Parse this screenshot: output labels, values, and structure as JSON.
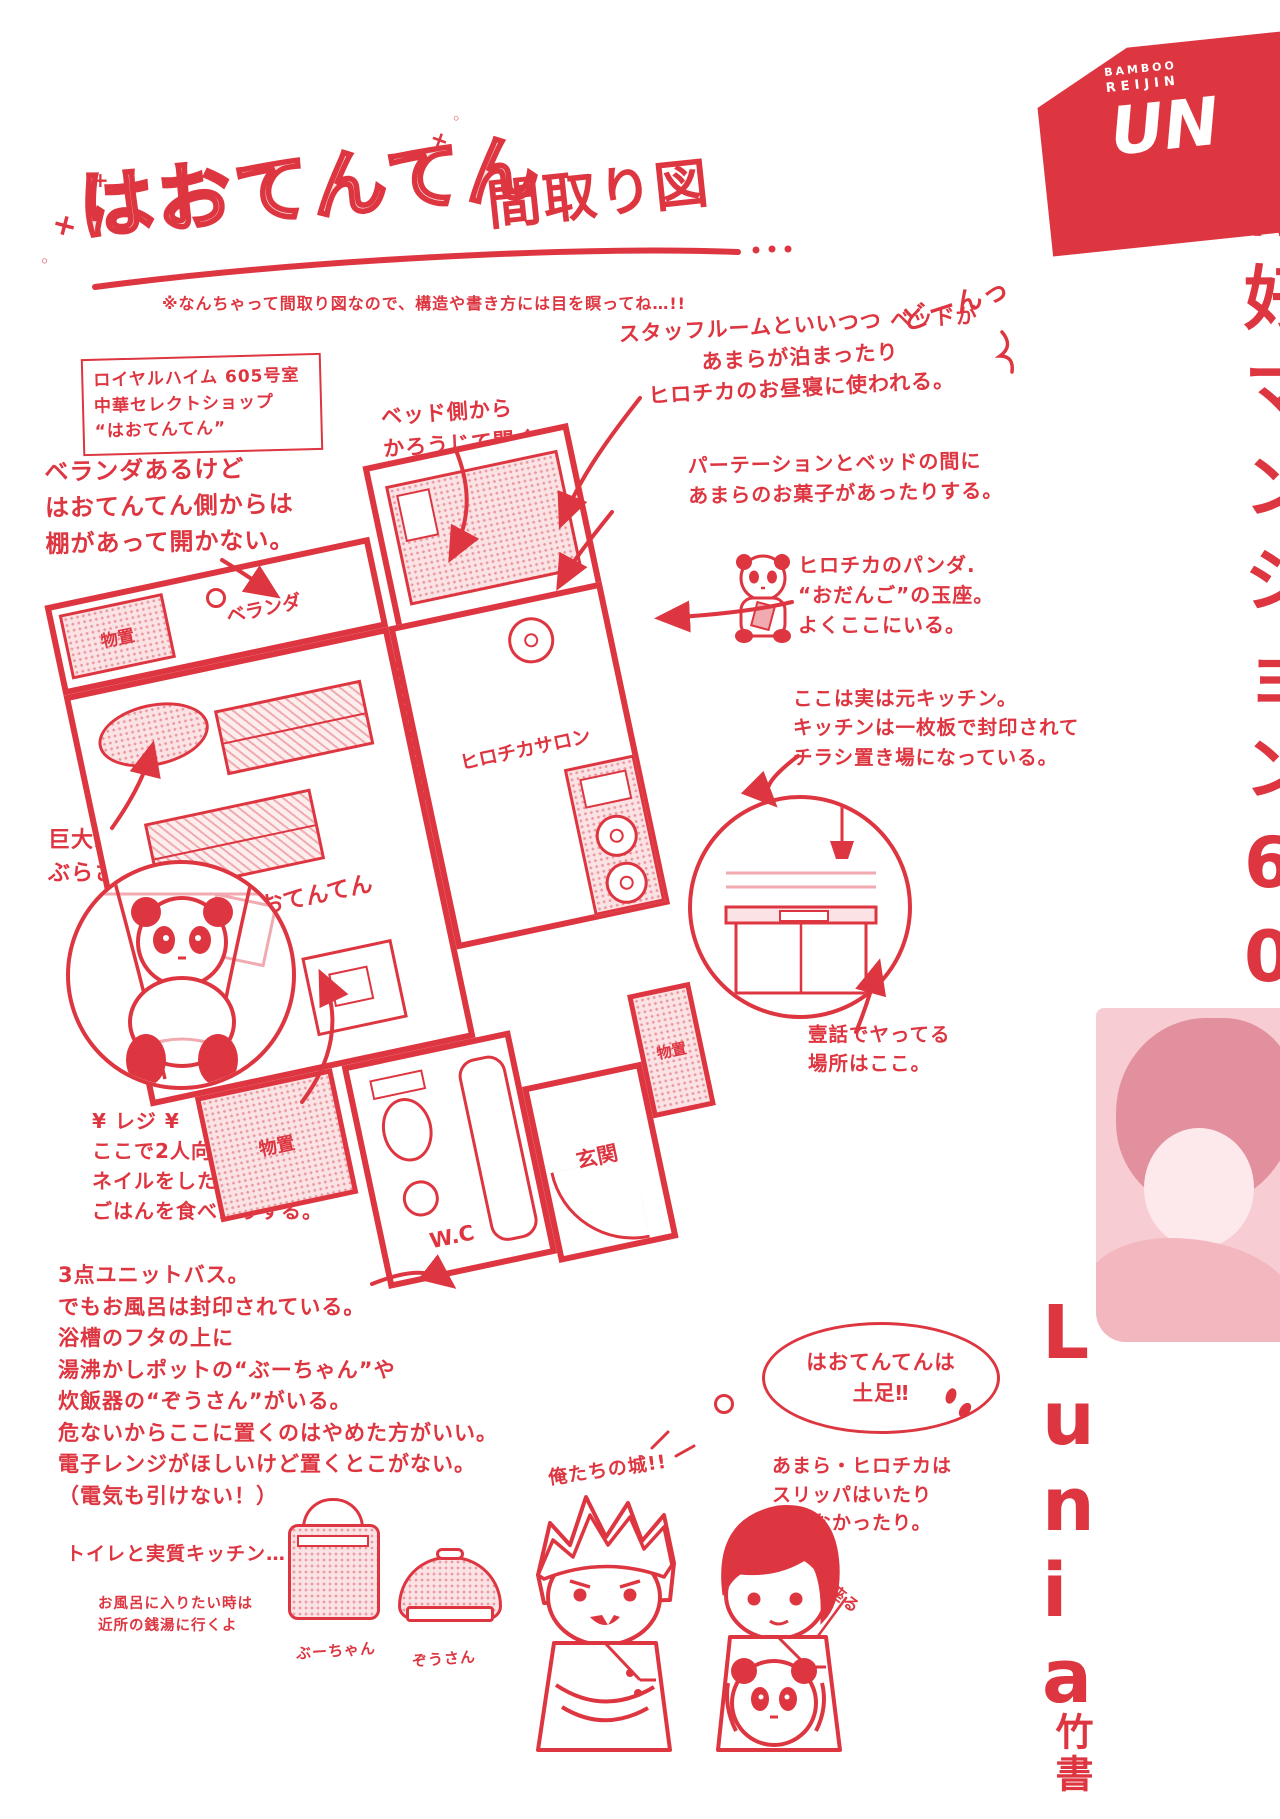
{
  "ink": "#de3641",
  "title": {
    "main": "はおてんてん",
    "suffix": "間取り図",
    "note": "※なんちゃって間取り図なので、構造や書き方には目を瞑ってね…!!"
  },
  "address_box": {
    "text": "ロイヤルハイム 605号室\n中華セレクトショップ\n“はおてんてん”"
  },
  "annotations": {
    "veranda_note": {
      "text": "ベランダあるけど\nはおてんてん側からは\n棚があって開かない。"
    },
    "bed_side": {
      "text": "ベッド側から\nかろうじて開く。"
    },
    "staff_room": {
      "text": "スタッフルームといいつつ ベッドが\nあまらが泊まったり\nヒロチカのお昼寝に使われる。"
    },
    "doon": {
      "text": "どーんっ"
    },
    "partition": {
      "text": "パーテーションとベッドの間に\nあまらのお菓子があったりする。"
    },
    "odango": {
      "text": "ヒロチカのパンダ.\n“おだんご”の玉座。\nよくここにいる。"
    },
    "ex_kitchen": {
      "text": "ここは実は元キッチン。\nキッチンは一枚板で封印されて\nチラシ置き場になっている。"
    },
    "giant_panda": {
      "text": "巨大パンダが\nぶらさがっている。"
    },
    "register": {
      "text": "¥ レジ ¥\nここで2人向かい合って\nネイルをしたり.\nごはんを食べたりする。"
    },
    "unit_bath": {
      "text": "3点ユニットバス。\nでもお風呂は封印されている。\n浴槽のフタの上に\n湯沸かしポットの“ぶーちゃん”や\n炊飯器の“ぞうさん”がいる。\n危ないからここに置くのはやめた方がいい。\n電子レンジがほしいけど置くとこがない。\n（電気も引けない！）"
    },
    "toilet_kitchen": {
      "text": "トイレと実質キッチン…"
    },
    "sento": {
      "text": "お風呂に入りたい時は\n近所の銭湯に行くよ"
    },
    "ep1": {
      "text": "壹話でヤってる\n場所はここ。"
    },
    "barefoot": {
      "text": "はおてんてんは\n土足‼"
    },
    "slippers": {
      "text": "あまら・ヒロチカは\nスリッパはいたり\nはかなかったり。"
    },
    "castle": {
      "text": "俺たちの城!!"
    },
    "squat": {
      "text": "一生居座る"
    }
  },
  "rooms": {
    "veranda": "ベランダ",
    "storage_top": "物置",
    "shop": "はおてんてん",
    "salon": "ヒロチカサロン",
    "storage_left": "物置",
    "wc": "W.C",
    "entrance": "玄関",
    "storage_right": "物置"
  },
  "appliances": {
    "pot": "ぶーちゃん",
    "cooker": "ぞうさん"
  },
  "sidebar": {
    "logo": {
      "line1": "BAMBOO",
      "line2": "REIJIN",
      "line3": "UN"
    },
    "title_chars": [
      "你",
      "好",
      "マ",
      "ン",
      "シ",
      "ョ",
      "ン",
      "6",
      "0",
      "5"
    ],
    "romaji": [
      "L",
      "u",
      "n",
      "i",
      "a"
    ],
    "publisher": "竹書"
  }
}
